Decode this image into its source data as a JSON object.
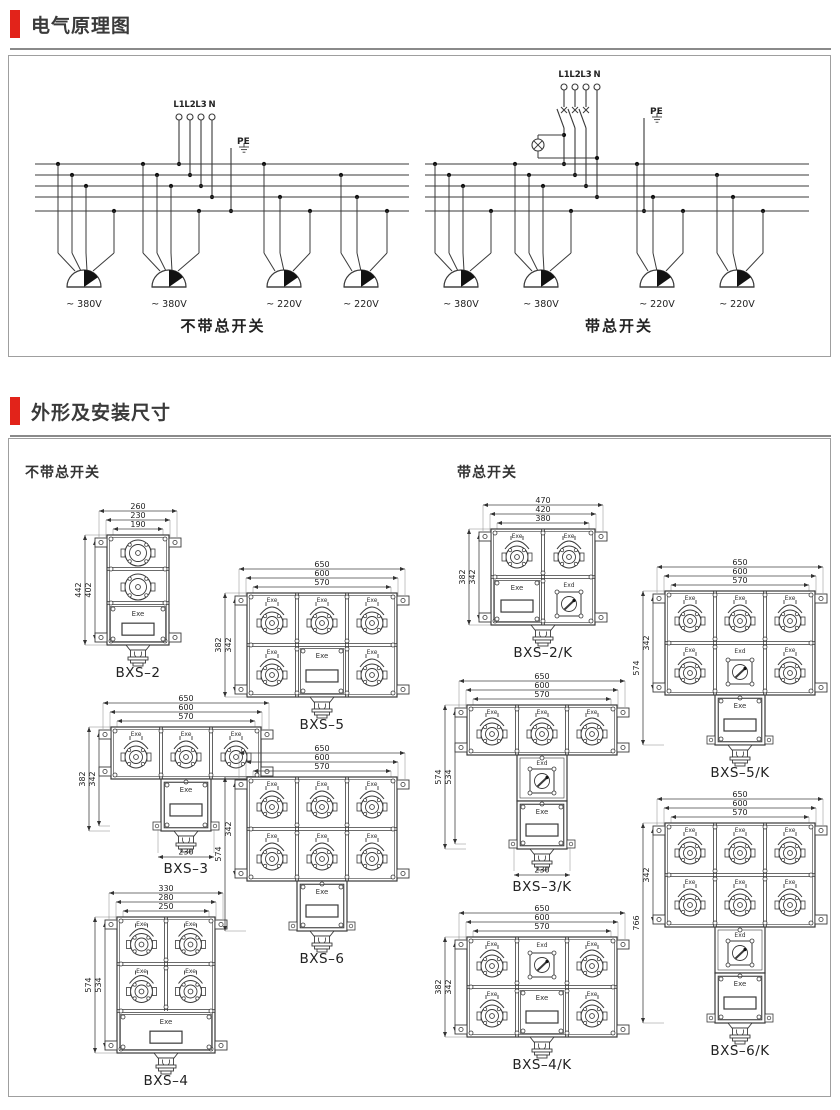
{
  "colors": {
    "accent": "#e2231a",
    "line": "#3a3a3a",
    "panel_border": "#9f9f9f"
  },
  "sections": {
    "schematic_title": "电气原理图",
    "dimensions_title": "外形及安装尺寸"
  },
  "circuit": {
    "terminals": [
      "L1",
      "L2",
      "L3",
      "N"
    ],
    "pe_label": "PE",
    "outputs": [
      "~ 380V",
      "~ 380V",
      "~ 220V",
      "~ 220V"
    ],
    "without_switch_caption": "不带总开关",
    "with_switch_caption": "带总开关"
  },
  "drawings_panel": {
    "left_group_label": "不带总开关",
    "right_group_label": "带总开关",
    "marking_exe": "Exe",
    "marking_exd": "Exd",
    "models": [
      {
        "id": "bxs2",
        "label": "BXS–2",
        "group": "without",
        "top_dims": [
          "260",
          "230",
          "190"
        ],
        "side_dims": [
          "442",
          "402"
        ],
        "bottom_dim": null,
        "grid": [
          "S",
          "S",
          "E"
        ],
        "tail": []
      },
      {
        "id": "bxs3",
        "label": "BXS–3",
        "group": "without",
        "top_dims": [
          "650",
          "600",
          "570"
        ],
        "side_dims": [
          "382",
          "342"
        ],
        "bottom_dim": "230",
        "grid": [
          "SSS"
        ],
        "tail": [
          "E"
        ]
      },
      {
        "id": "bxs4",
        "label": "BXS–4",
        "group": "without",
        "top_dims": [
          "330",
          "280",
          "250"
        ],
        "side_dims": [
          "574",
          "534"
        ],
        "bottom_dim": null,
        "grid": [
          "SS",
          "SS",
          "E"
        ],
        "tail": []
      },
      {
        "id": "bxs5",
        "label": "BXS–5",
        "group": "without",
        "top_dims": [
          "650",
          "600",
          "570"
        ],
        "side_dims": [
          "382",
          "342"
        ],
        "bottom_dim": null,
        "grid": [
          "SSS",
          "SES"
        ],
        "tail": []
      },
      {
        "id": "bxs6",
        "label": "BXS–6",
        "group": "without",
        "top_dims": [
          "650",
          "600",
          "570"
        ],
        "side_dims": [
          "574",
          "342"
        ],
        "bottom_dim": null,
        "grid": [
          "SSS",
          "SSS"
        ],
        "tail": [
          "E"
        ]
      },
      {
        "id": "bxs2k",
        "label": "BXS–2/K",
        "group": "with",
        "top_dims": [
          "470",
          "420",
          "380"
        ],
        "side_dims": [
          "382",
          "342"
        ],
        "bottom_dim": null,
        "grid": [
          "SS",
          "EK"
        ],
        "tail": []
      },
      {
        "id": "bxs3k",
        "label": "BXS–3/K",
        "group": "with",
        "top_dims": [
          "650",
          "600",
          "570"
        ],
        "side_dims": [
          "574",
          "534"
        ],
        "bottom_dim": "230",
        "grid": [
          "SSS"
        ],
        "tail": [
          "K",
          "E"
        ]
      },
      {
        "id": "bxs4k",
        "label": "BXS–4/K",
        "group": "with",
        "top_dims": [
          "650",
          "600",
          "570"
        ],
        "side_dims": [
          "382",
          "342"
        ],
        "bottom_dim": null,
        "grid": [
          "SKS",
          "SES"
        ],
        "tail": []
      },
      {
        "id": "bxs5k",
        "label": "BXS–5/K",
        "group": "with",
        "top_dims": [
          "650",
          "600",
          "570"
        ],
        "side_dims": [
          "574",
          "342"
        ],
        "bottom_dim": null,
        "grid": [
          "SSS",
          "SKS"
        ],
        "tail": [
          "E"
        ]
      },
      {
        "id": "bxs6k",
        "label": "BXS–6/K",
        "group": "with",
        "top_dims": [
          "650",
          "600",
          "570"
        ],
        "side_dims": [
          "766",
          "342"
        ],
        "bottom_dim": null,
        "grid": [
          "SSS",
          "SSS"
        ],
        "tail": [
          "K",
          "E"
        ]
      }
    ]
  }
}
